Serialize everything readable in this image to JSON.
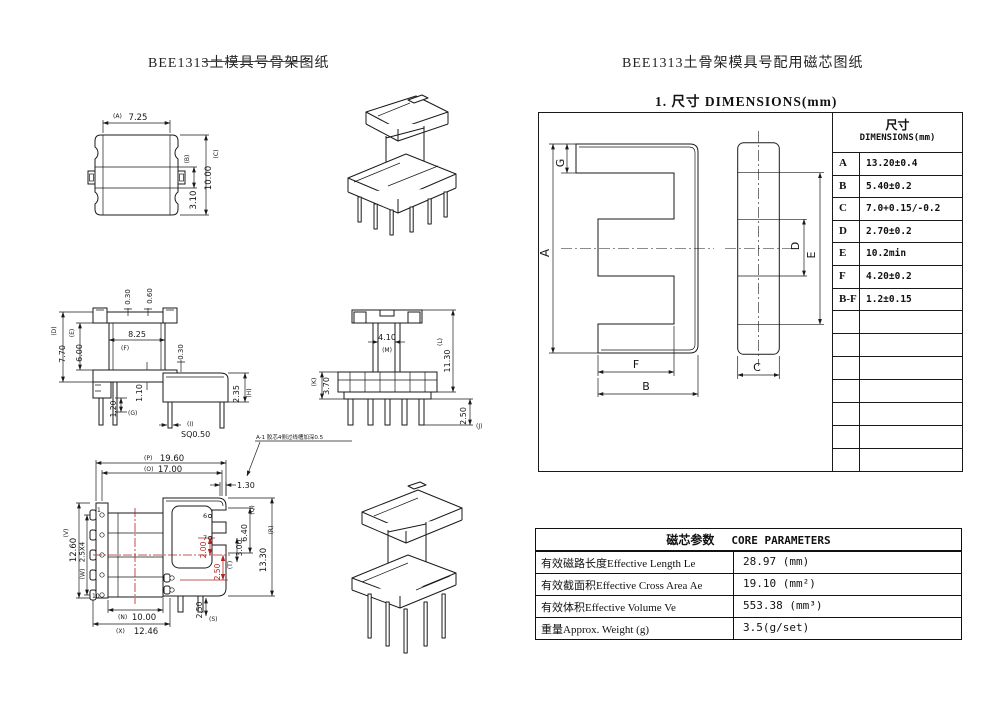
{
  "titles": {
    "left": "BEE1313土模具号骨架图纸",
    "right": "BEE1313土骨架模具号配用磁芯图纸",
    "section": "1. 尺寸 DIMENSIONS(mm)"
  },
  "dim_table": {
    "header_cn": "尺寸",
    "header_en": "DIMENSIONS(mm)",
    "rows": [
      {
        "label": "A",
        "value": "13.20±0.4"
      },
      {
        "label": "B",
        "value": "5.40±0.2"
      },
      {
        "label": "C",
        "value": "7.0+0.15/-0.2"
      },
      {
        "label": "D",
        "value": "2.70±0.2"
      },
      {
        "label": "E",
        "value": "10.2min"
      },
      {
        "label": "F",
        "value": "4.20±0.2"
      },
      {
        "label": "B-F",
        "value": "1.2±0.15"
      }
    ],
    "empty_rows": 7
  },
  "core_table": {
    "title_cn": "磁芯参数",
    "title_en": "CORE PARAMETERS",
    "rows": [
      {
        "label": "有效磁路长度Effective Length  Le",
        "value": "28.97 (mm)"
      },
      {
        "label": "有效截面积Effective Cross Area Ae",
        "value": "19.10 (mm²)"
      },
      {
        "label": "有效体积Effective Volume Ve",
        "value": "553.38 (mm³)"
      },
      {
        "label": "重量Approx. Weight (g)",
        "value": "3.5(g/set)"
      }
    ]
  },
  "core_view": {
    "a": "A",
    "b": "B",
    "c": "C",
    "d": "D",
    "e": "E",
    "f": "F",
    "g": "G"
  },
  "drawings": {
    "top_view": {
      "label_a": "(A)",
      "val_a": "7.25",
      "label_b": "(B)",
      "val_b": "3.10",
      "label_c": "(C)",
      "val_c": "10.00"
    },
    "side_view": {
      "v030_top": "0.30",
      "v060": "0.60",
      "label_d": "(D)",
      "val_d": "7.70",
      "label_e": "(E)",
      "val_e": "6.00",
      "label_f": "(F)",
      "val_f": "8.25",
      "v030_right": "0.30",
      "v110": "1.10",
      "label_g": "(G)",
      "val_g": "1.20",
      "label_h": "(H)",
      "val_h": "2.35",
      "label_i": "(I)",
      "val_i": "SQ0.50"
    },
    "front_view": {
      "val_m": "4.10",
      "label_m": "(M)",
      "label_l": "(L)",
      "val_l": "11.30",
      "label_k": "(K)",
      "val_k": "3.70",
      "val_j": "2.50",
      "label_j": "(J)"
    },
    "bottom_view": {
      "label_p": "(P)",
      "val_p": "19.60",
      "label_o": "(O)",
      "val_o": "17.00",
      "v130": "1.30",
      "label_v": "(V)",
      "val_v": "12.60",
      "label_w": "(W)",
      "val_w": "2.5X4",
      "val_q": "6.40",
      "label_q": "(Q)",
      "val_r": "13.30",
      "label_r": "(R)",
      "val_t": "3.00",
      "label_t": "(T)",
      "val_s": "2.50",
      "label_s": "(S)",
      "label_n": "(N)",
      "val_n": "10.00",
      "label_x": "(X)",
      "val_x": "12.46",
      "red_a": "2.00",
      "red_b": "2.50",
      "pin1": "1",
      "pin6": "6",
      "pin7": "7",
      "pin10": "10"
    },
    "note": {
      "text": "A-1 胶芯4侧过线槽加深0.5"
    }
  },
  "colors": {
    "line": "#1a1a1a",
    "red_dim": "#b32424",
    "background": "#ffffff"
  }
}
